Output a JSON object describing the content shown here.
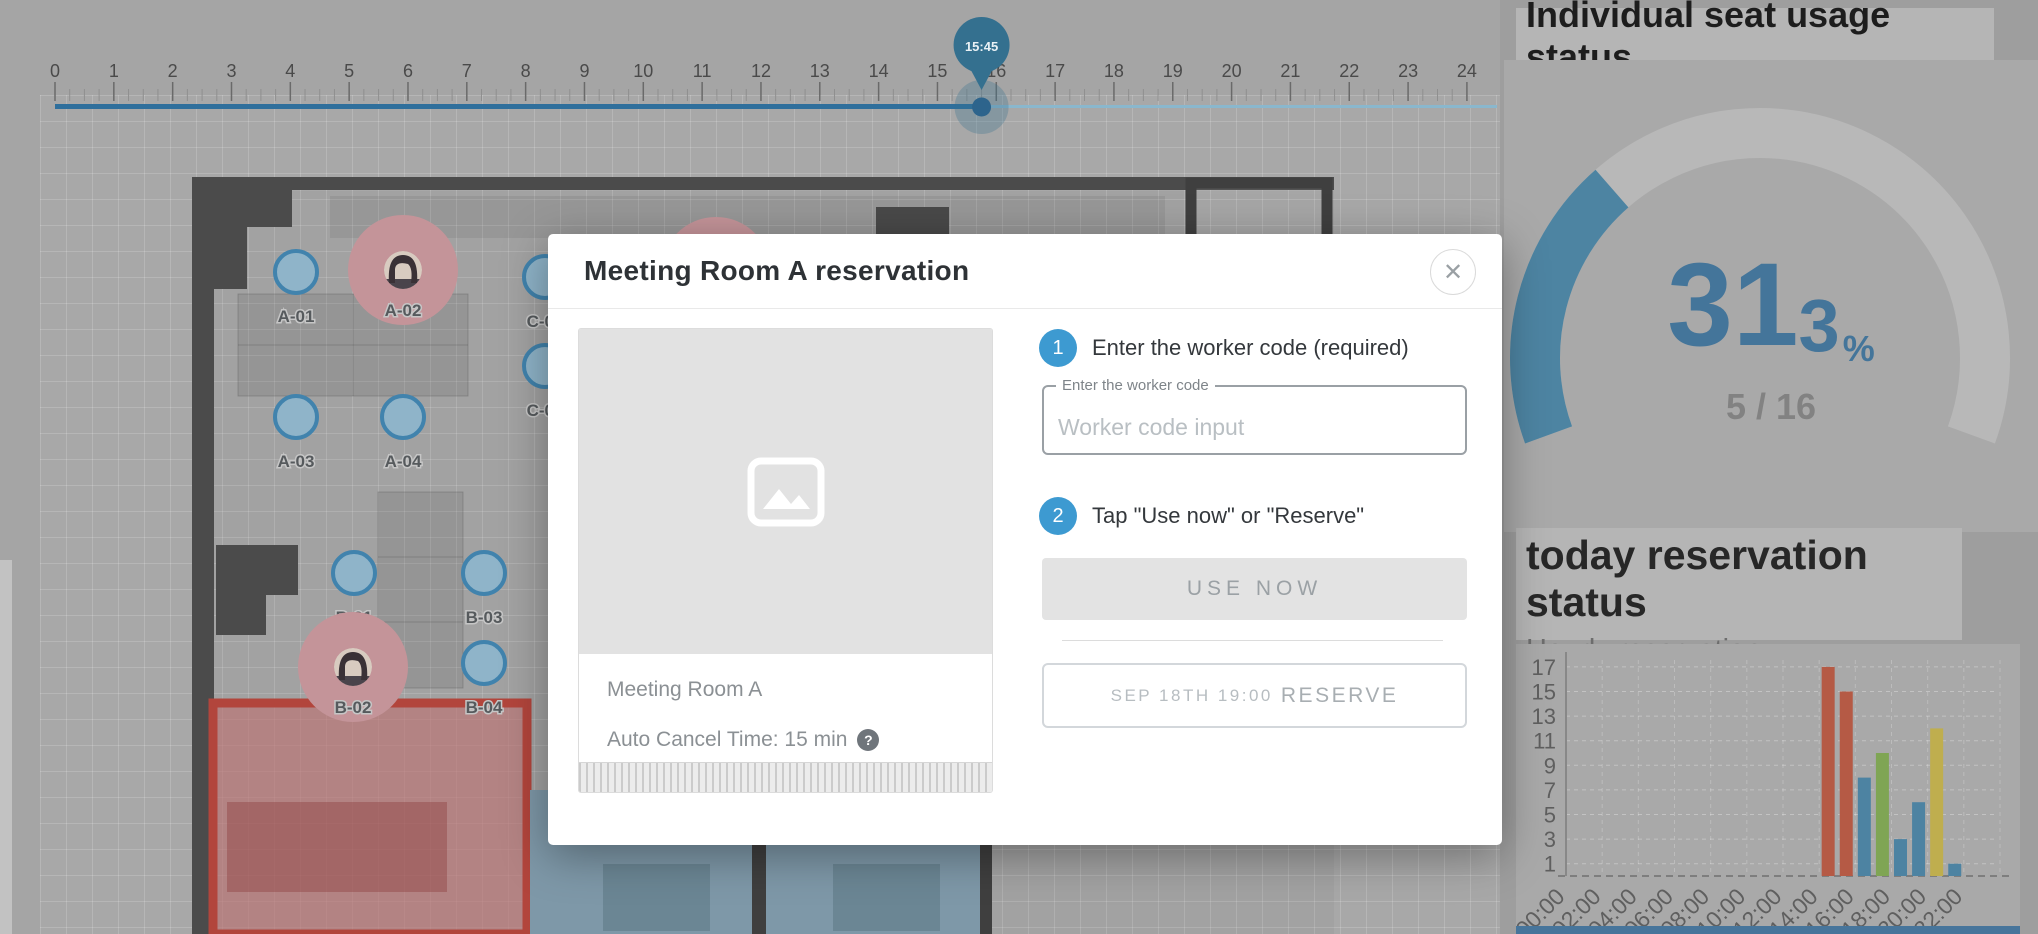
{
  "timeline": {
    "hour_labels": [
      "0",
      "1",
      "2",
      "3",
      "4",
      "5",
      "6",
      "7",
      "8",
      "9",
      "10",
      "11",
      "12",
      "13",
      "14",
      "15",
      "16",
      "17",
      "18",
      "19",
      "20",
      "21",
      "22",
      "23",
      "24"
    ],
    "marker": {
      "label": "15:45",
      "hour": 15.75
    },
    "colors": {
      "done_line": "#2f6f9c",
      "rest_line": "#8ab7cd",
      "pin": "#34708f",
      "dot": "#2d648c"
    }
  },
  "floorplan": {
    "seat_colors": {
      "fill": "#8fb4c9",
      "border": "#4183ad",
      "occupied": "#c49499",
      "label": "#565a5d"
    },
    "seats": [
      {
        "label": "A-01",
        "x": 296,
        "y": 272,
        "occupied": false
      },
      {
        "label": "A-02",
        "x": 403,
        "y": 270,
        "occupied": true
      },
      {
        "label": "A-03",
        "x": 296,
        "y": 417,
        "occupied": false
      },
      {
        "label": "A-04",
        "x": 403,
        "y": 417,
        "occupied": false
      },
      {
        "label": "B-01",
        "x": 354,
        "y": 573,
        "occupied": false
      },
      {
        "label": "B-02",
        "x": 353,
        "y": 667,
        "occupied": true
      },
      {
        "label": "B-03",
        "x": 484,
        "y": 573,
        "occupied": false
      },
      {
        "label": "B-04",
        "x": 484,
        "y": 663,
        "occupied": false
      },
      {
        "label": "C-01",
        "x": 545,
        "y": 277,
        "occupied": false
      },
      {
        "label": "C-02",
        "x": 545,
        "y": 366,
        "occupied": false
      },
      {
        "label": "",
        "x": 716,
        "y": 272,
        "occupied": true
      }
    ]
  },
  "modal": {
    "title": "Meeting Room A reservation",
    "close_icon": "✕",
    "room": {
      "name": "Meeting Room A",
      "auto_cancel_label": "Auto Cancel Time: 15 min",
      "help_icon": "?",
      "image_icon": "image-placeholder"
    },
    "steps": [
      {
        "number": "1",
        "text": "Enter the worker code (required)"
      },
      {
        "number": "2",
        "text": "Tap \"Use now\" or \"Reserve\""
      }
    ],
    "input": {
      "label": "Enter the worker code",
      "placeholder": "Worker code input",
      "value": ""
    },
    "buttons": {
      "use_now": "USE NOW",
      "reserve_date": "SEP 18TH 19:00",
      "reserve": "RESERVE"
    },
    "accent_color": "#3d9ad1"
  },
  "right_panel": {
    "seat_usage": {
      "title": "Individual seat usage status",
      "percent_int": "31",
      "percent_dec": "3",
      "percent_sign": "%",
      "fraction": "5 / 16"
    },
    "reservation": {
      "title": "today reservation status",
      "subtitle": "Hourly reservation"
    }
  },
  "chart_data": [
    {
      "type": "gauge",
      "title": "Individual seat usage status",
      "value": 31.3,
      "max": 100,
      "display": "31.3%",
      "used": 5,
      "total": 16,
      "fraction_label": "5 / 16",
      "arc_color": "#4d84a2",
      "track_color": "#b8b8b8",
      "start_angle_deg": 160,
      "sweep_deg": 220
    },
    {
      "type": "bar",
      "title": "today reservation status",
      "subtitle": "Hourly reservation",
      "categories": [
        "00:00",
        "01:00",
        "02:00",
        "03:00",
        "04:00",
        "05:00",
        "06:00",
        "07:00",
        "08:00",
        "09:00",
        "10:00",
        "11:00",
        "12:00",
        "13:00",
        "14:00",
        "15:00",
        "16:00",
        "17:00",
        "18:00",
        "19:00",
        "20:00",
        "21:00",
        "22:00",
        "23:00"
      ],
      "values": [
        0,
        0,
        0,
        0,
        0,
        0,
        0,
        0,
        0,
        0,
        0,
        0,
        0,
        0,
        17,
        15,
        8,
        10,
        3,
        6,
        12,
        1,
        0,
        0
      ],
      "bar_colors": [
        null,
        null,
        null,
        null,
        null,
        null,
        null,
        null,
        null,
        null,
        null,
        null,
        null,
        null,
        "#b55a45",
        "#b55a45",
        "#4d83a2",
        "#7fa554",
        "#4d83a2",
        "#4d83a2",
        "#bfae4e",
        "#4d83a2",
        null,
        null
      ],
      "yticks": [
        1,
        3,
        5,
        7,
        9,
        11,
        13,
        15,
        17
      ],
      "xtick_labels": [
        "00:00",
        "02:00",
        "04:00",
        "06:00",
        "08:00",
        "10:00",
        "12:00",
        "14:00",
        "16:00",
        "18:00",
        "20:00",
        "22:00"
      ],
      "ylim": [
        0,
        18
      ],
      "grid": true,
      "legend": null
    }
  ]
}
